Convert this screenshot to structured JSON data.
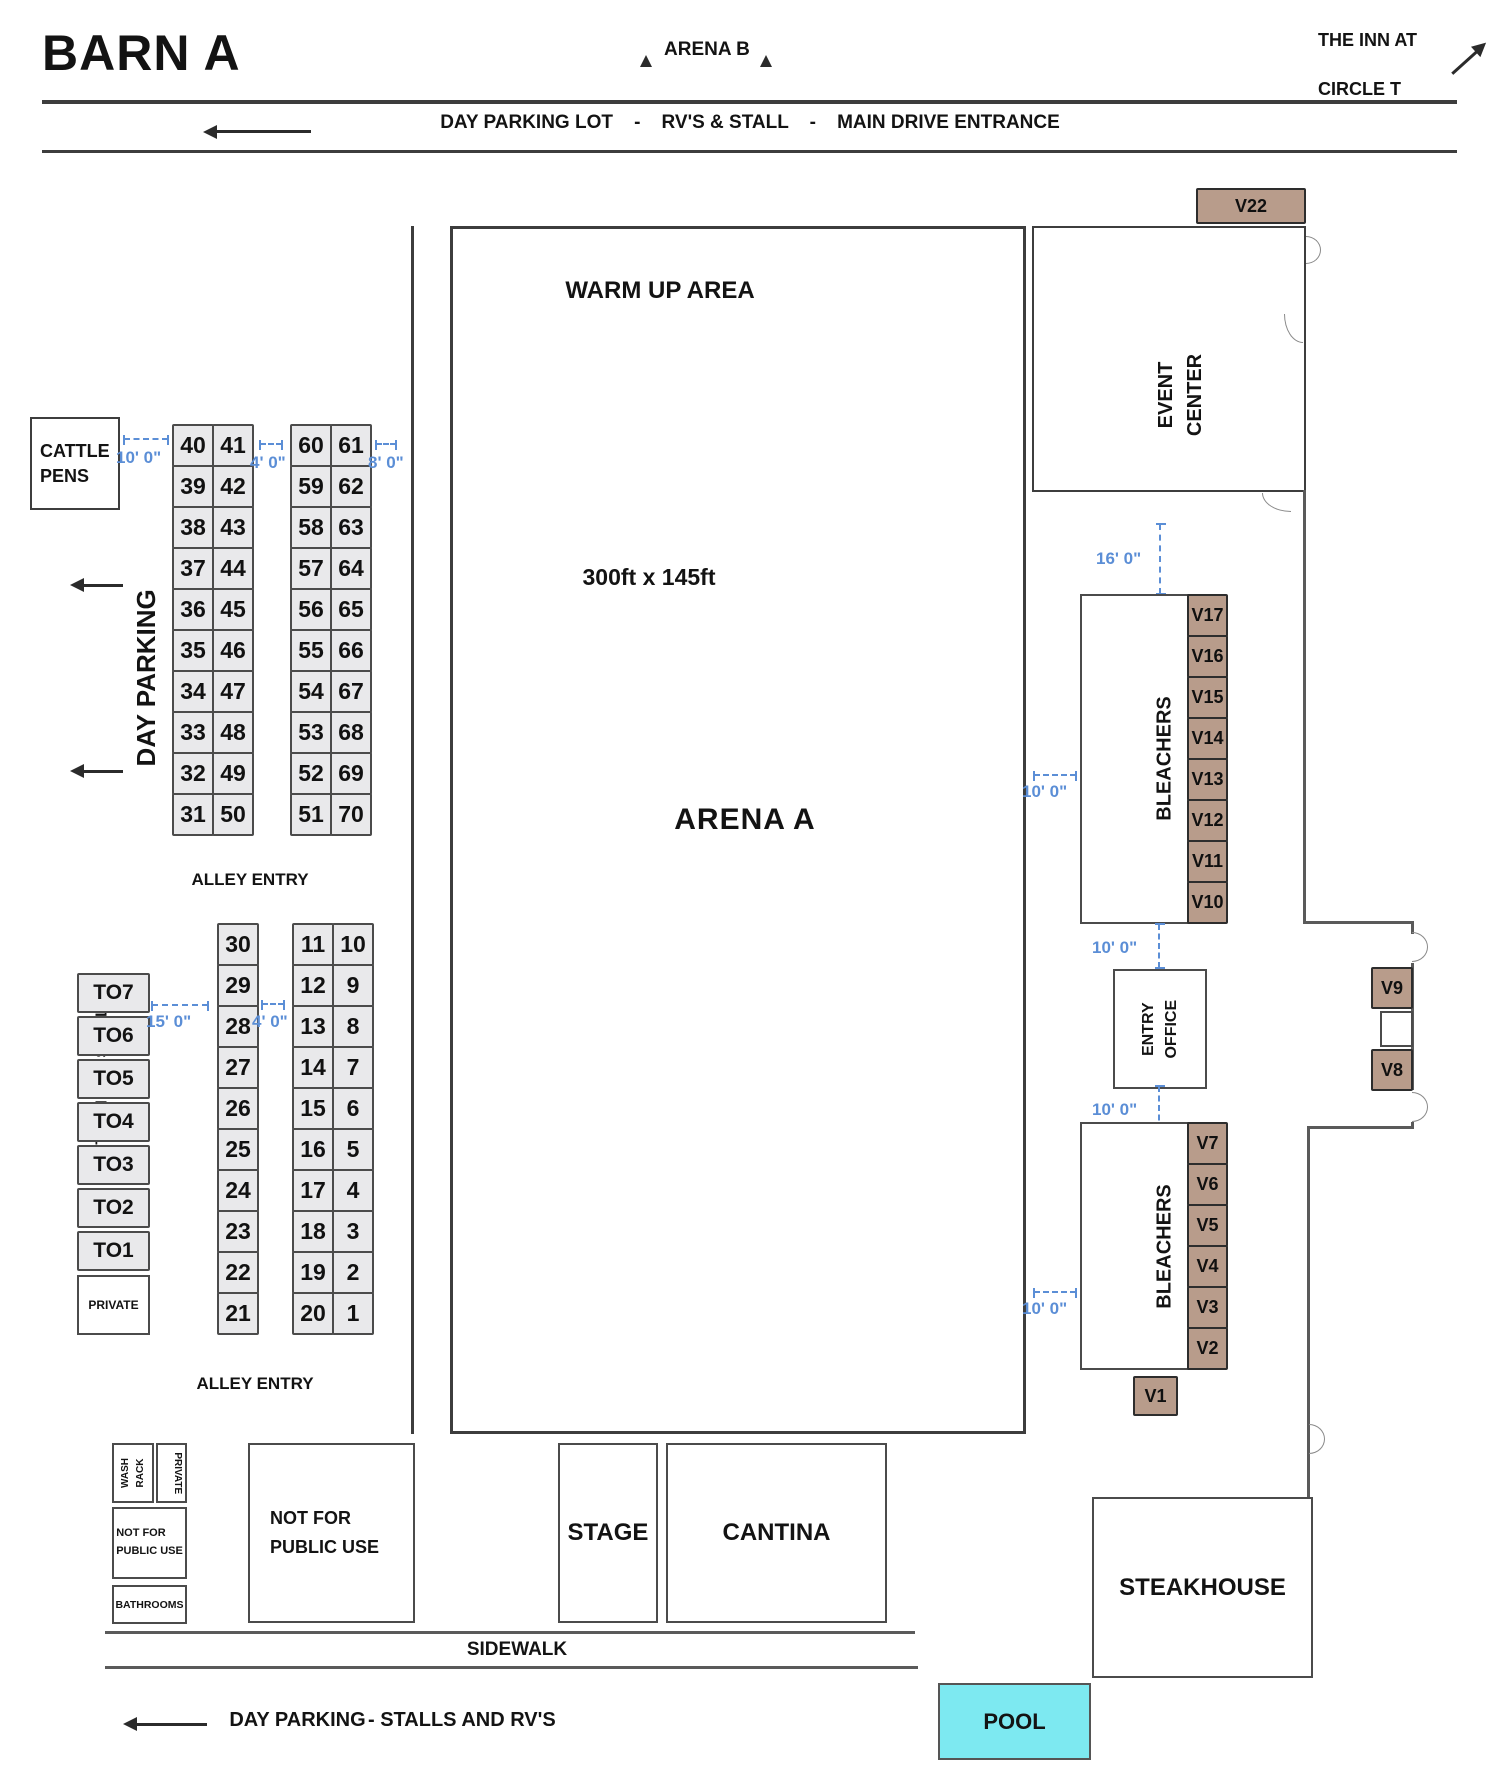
{
  "title": "BARN A",
  "top": {
    "arena_b": "ARENA B",
    "inn_line1": "THE INN AT",
    "inn_line2": "CIRCLE T",
    "route": "DAY PARKING LOT    -    RV'S & STALL    -    MAIN DRIVE ENTRANCE"
  },
  "left": {
    "cattle_pens": "CATTLE\nPENS",
    "day_parking": "DAY PARKING",
    "turn_out": "TURN OUT STALLS",
    "alley_entry": "ALLEY ENTRY",
    "private_stall": "PRIVATE"
  },
  "arena": {
    "warm_up": "WARM UP AREA",
    "size": "300ft x 145ft",
    "name": "ARENA A",
    "return_alley": "RETURN ALLEY"
  },
  "right": {
    "event_center": "EVENT\nCENTER",
    "bleachers": "BLEACHERS",
    "entry_office": "ENTRY\nOFFICE",
    "open_parking": "OPEN PARKING - NO TRAILERS",
    "alamo": "ALAMO ENTRANCE"
  },
  "bottom": {
    "wash_rack": "WASH\nRACK",
    "private": "PRIVATE",
    "not_public_small": "NOT FOR\nPUBLIC USE",
    "bathrooms": "BATHROOMS",
    "not_public_big": "NOT FOR\nPUBLIC USE",
    "stage": "STAGE",
    "cantina": "CANTINA",
    "steakhouse": "STEAKHOUSE",
    "pool": "POOL",
    "sidewalk": "SIDEWALK",
    "route_label": "DAY PARKING",
    "route_suffix": "- STALLS AND RV'S"
  },
  "dims": {
    "d4": "4' 0\"",
    "d8": "8' 0\"",
    "d10": "10' 0\"",
    "d15": "15' 0\"",
    "d16": "16' 0\""
  },
  "stalls": {
    "gridA": [
      [
        "40",
        "41"
      ],
      [
        "39",
        "42"
      ],
      [
        "38",
        "43"
      ],
      [
        "37",
        "44"
      ],
      [
        "36",
        "45"
      ],
      [
        "35",
        "46"
      ],
      [
        "34",
        "47"
      ],
      [
        "33",
        "48"
      ],
      [
        "32",
        "49"
      ],
      [
        "31",
        "50"
      ]
    ],
    "gridB": [
      [
        "60",
        "61"
      ],
      [
        "59",
        "62"
      ],
      [
        "58",
        "63"
      ],
      [
        "57",
        "64"
      ],
      [
        "56",
        "65"
      ],
      [
        "55",
        "66"
      ],
      [
        "54",
        "67"
      ],
      [
        "53",
        "68"
      ],
      [
        "52",
        "69"
      ],
      [
        "51",
        "70"
      ]
    ],
    "gridC": [
      "30",
      "29",
      "28",
      "27",
      "26",
      "25",
      "24",
      "23",
      "22",
      "21"
    ],
    "gridD": [
      [
        "11",
        "10"
      ],
      [
        "12",
        "9"
      ],
      [
        "13",
        "8"
      ],
      [
        "14",
        "7"
      ],
      [
        "15",
        "6"
      ],
      [
        "16",
        "5"
      ],
      [
        "17",
        "4"
      ],
      [
        "18",
        "3"
      ],
      [
        "19",
        "2"
      ],
      [
        "20",
        "1"
      ]
    ],
    "turnout": [
      "TO7",
      "TO6",
      "TO5",
      "TO4",
      "TO3",
      "TO2",
      "TO1"
    ],
    "v_top": [
      "V17",
      "V16",
      "V15",
      "V14",
      "V13",
      "V12",
      "V11",
      "V10"
    ],
    "v_bottom": [
      "V7",
      "V6",
      "V5",
      "V4",
      "V3",
      "V2"
    ],
    "v22": "V22",
    "v9": "V9",
    "v8": "V8",
    "v1": "V1"
  },
  "colors": {
    "vendor_tan": "#b89c8b",
    "stall_gray": "#e9e9eb",
    "pool_cyan": "#7de9f1",
    "dim_blue": "#5b8ed6",
    "wall_dark": "#3d3d3d"
  }
}
